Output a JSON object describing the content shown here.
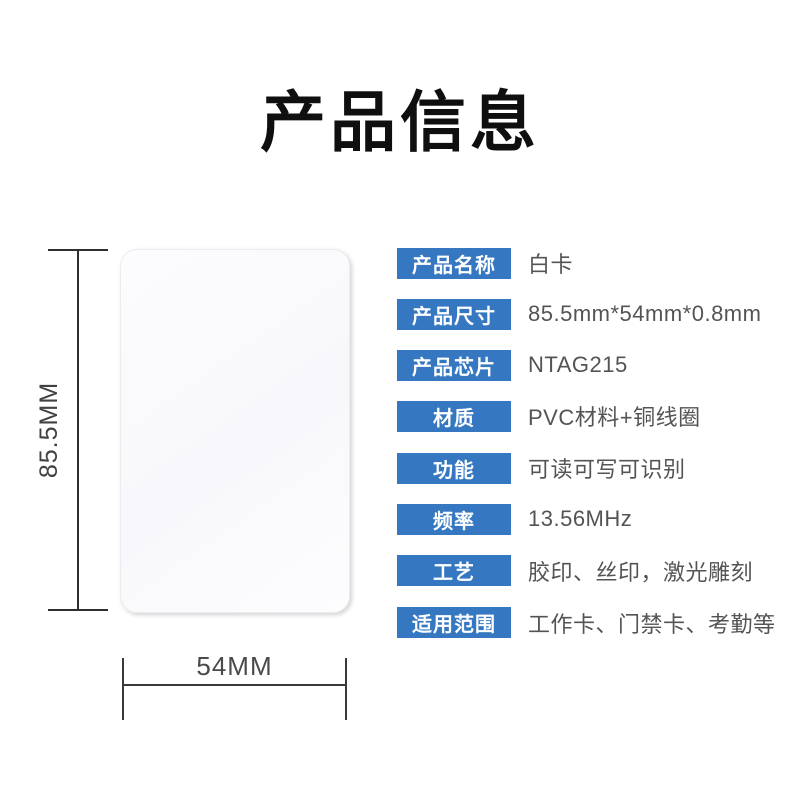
{
  "page": {
    "title": "产品信息",
    "background": "#ffffff"
  },
  "colors": {
    "accent_blue": "#3578c1",
    "label_text": "#ffffff",
    "value_text": "#545454",
    "dimension_line": "#333333",
    "title_text": "#0f0f0f"
  },
  "figure": {
    "card_name": "white-card",
    "height_label": "85.5MM",
    "width_label": "54MM"
  },
  "specs": {
    "rows": [
      {
        "label": "产品名称",
        "value": "白卡"
      },
      {
        "label": "产品尺寸",
        "value": "85.5mm*54mm*0.8mm"
      },
      {
        "label": "产品芯片",
        "value": "NTAG215"
      },
      {
        "label": "材质",
        "value": "PVC材料+铜线圈"
      },
      {
        "label": "功能",
        "value": "可读可写可识别"
      },
      {
        "label": "频率",
        "value": "13.56MHz"
      },
      {
        "label": "工艺",
        "value": "胶印、丝印，激光雕刻"
      },
      {
        "label": "适用范围",
        "value": "工作卡、门禁卡、考勤等"
      }
    ]
  }
}
